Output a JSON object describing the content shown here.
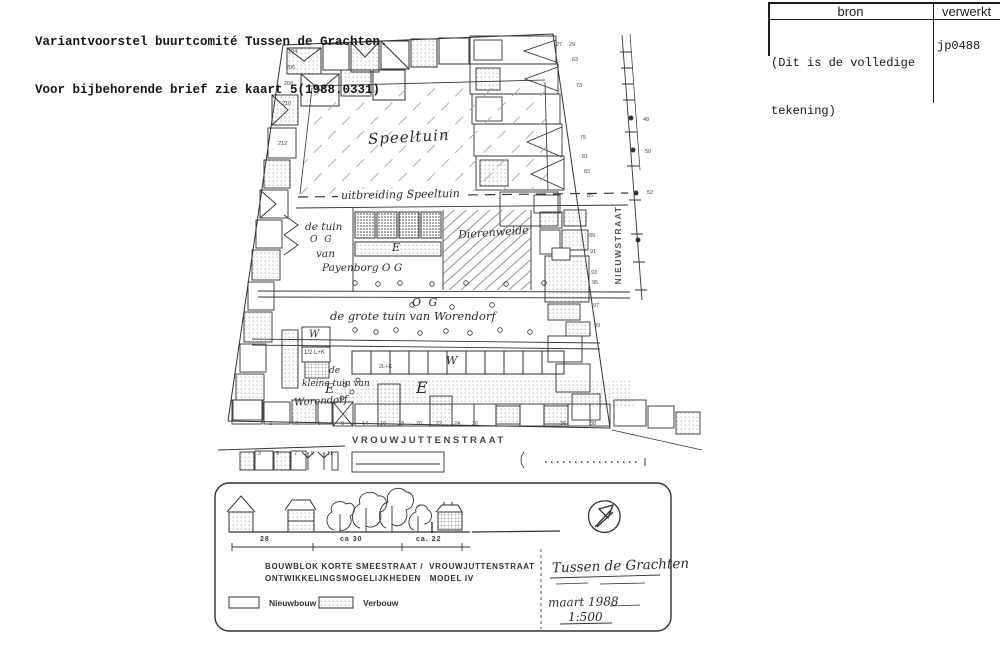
{
  "header": {
    "title_line1": "Variantvoorstel buurtcomité Tussen de Grachten.",
    "title_line2": "Voor bijbehorende brief zie kaart 5(1988.0331)"
  },
  "register_table": {
    "col1_header": "bron",
    "col2_header": "verwerkt",
    "bron_note_line1": "(Dit is de volledige",
    "bron_note_line2": "tekening)",
    "verwerkt_value": "jp0488"
  },
  "map": {
    "labels": {
      "speeltuin": "Speeltuin",
      "uitbreiding_speeltuin": "uitbreiding Speeltuin",
      "de_tuin": "de tuin",
      "og_payenborg": "O G",
      "van": "van",
      "payenborg": "Payenborg O G",
      "e_strip": "E",
      "dierenweide": "Dierenweide",
      "og_grote_tuin": "O G",
      "grote_tuin": "de grote tuin van Worendorf",
      "w_left": "W",
      "half_lk": "1/2 L+K",
      "two_lk": "2L+K",
      "w_garage": "W",
      "de": "de",
      "kleine_tuin": "kleine tuin van",
      "worendorf": "Worendorf",
      "e_kleine": "E",
      "e_groot": "E",
      "street_right": "NIEUWSTRAAT",
      "street_bottom": "VROUWJUTTENSTRAAT"
    },
    "house_numbers_bottom": [
      "2",
      "4",
      "6",
      "8",
      "14",
      "16",
      "18",
      "20",
      "22",
      "24",
      "26",
      "36",
      "38"
    ],
    "house_numbers_south_side": [
      "3",
      "5",
      "7",
      "9",
      "11"
    ],
    "house_numbers_left": [
      "204",
      "206",
      "208",
      "210",
      "212"
    ],
    "house_numbers_right_block": [
      "27",
      "29",
      "63",
      "73",
      "75",
      "81",
      "83",
      "85"
    ],
    "house_numbers_right_lower": [
      "89",
      "91",
      "93",
      "95",
      "97",
      "99"
    ],
    "house_numbers_across_street": [
      "48",
      "50",
      "52"
    ]
  },
  "legend": {
    "dim_1": "28",
    "dim_2": "ca 30",
    "dim_3": "ca. 22",
    "title_line1": "BOUWBLOK KORTE SMEESTRAAT /  VROUWJUTTENSTRAAT",
    "title_line2": "ONTWIKKELINGSMOGELIJKHEDEN   MODEL IV",
    "swatch_new_label": "Nieuwbouw",
    "swatch_rebuild_label": "Verbouw",
    "project_title": "Tussen de Grachten",
    "date": "maart 1988",
    "scale": "1:500"
  },
  "colors": {
    "ink": "#2f2f2f",
    "paper": "#fefefe",
    "stipple_light": "#8f8f8f",
    "stipple_dark": "#474747"
  }
}
